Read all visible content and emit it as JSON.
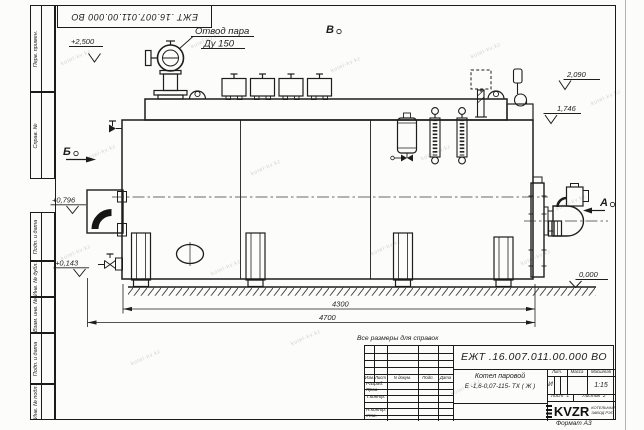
{
  "watermark": {
    "text": "kotel-kv.kz"
  },
  "sheet": {
    "designation_flipped": "ЕЖТ .16.007.011.00.000  ВО",
    "format_note": "Формат А3",
    "margin_columns": {
      "perv_primen": "Перв. примен.",
      "sprav_no": "Справ. №",
      "podp_data_1": "Подп. и дата",
      "inv_dubl": "Инв. № дубл.",
      "vzam_inv": "Взам. инв. №",
      "podp_data_2": "Подп. и дата",
      "inv_podl": "Инв. № подл."
    }
  },
  "drawing": {
    "callout_steam": {
      "line1": "Отвод пара",
      "line2": "Ду 150"
    },
    "views": {
      "top": "В",
      "left": "Б",
      "right": "А"
    },
    "elevations": {
      "e2500": "+2,500",
      "e2090": "2,090",
      "e1746": "1,746",
      "e0796": "+0,796",
      "e0143": "+0,143",
      "e0000": "0,000"
    },
    "dims": {
      "d4300": "4300",
      "d4700": "4700"
    }
  },
  "title_block": {
    "note_above": "Все размеры для справок",
    "designation": "ЕЖТ .16.007.011.00.000  ВО",
    "product_name": "Котел паровой",
    "product_code": "Е -1,6-0,07-115- ТХ ( Ж )",
    "cols": {
      "izm": "Изм.",
      "list": "Лист",
      "doc": "N докум.",
      "podp": "Подп.",
      "data": "Дата"
    },
    "rows": {
      "razrab": "Разраб.",
      "prov": "Пров.",
      "tkontr": "Т.контр.",
      "nkontr": "Н.контр.",
      "utv": "Утв."
    },
    "lit": {
      "header": "Лит.",
      "value": "И"
    },
    "massa": {
      "header": "Масса"
    },
    "scale": {
      "header": "Масштаб",
      "value": "1:15"
    },
    "sheet_no": {
      "label": "Лист",
      "value": "1"
    },
    "sheets_total": {
      "label": "Листов",
      "value": "2"
    },
    "company": {
      "logo": "KVZR",
      "line1": "КОТЕЛЬНЫЙ",
      "line2": "ЗАВОД РЭП"
    }
  }
}
